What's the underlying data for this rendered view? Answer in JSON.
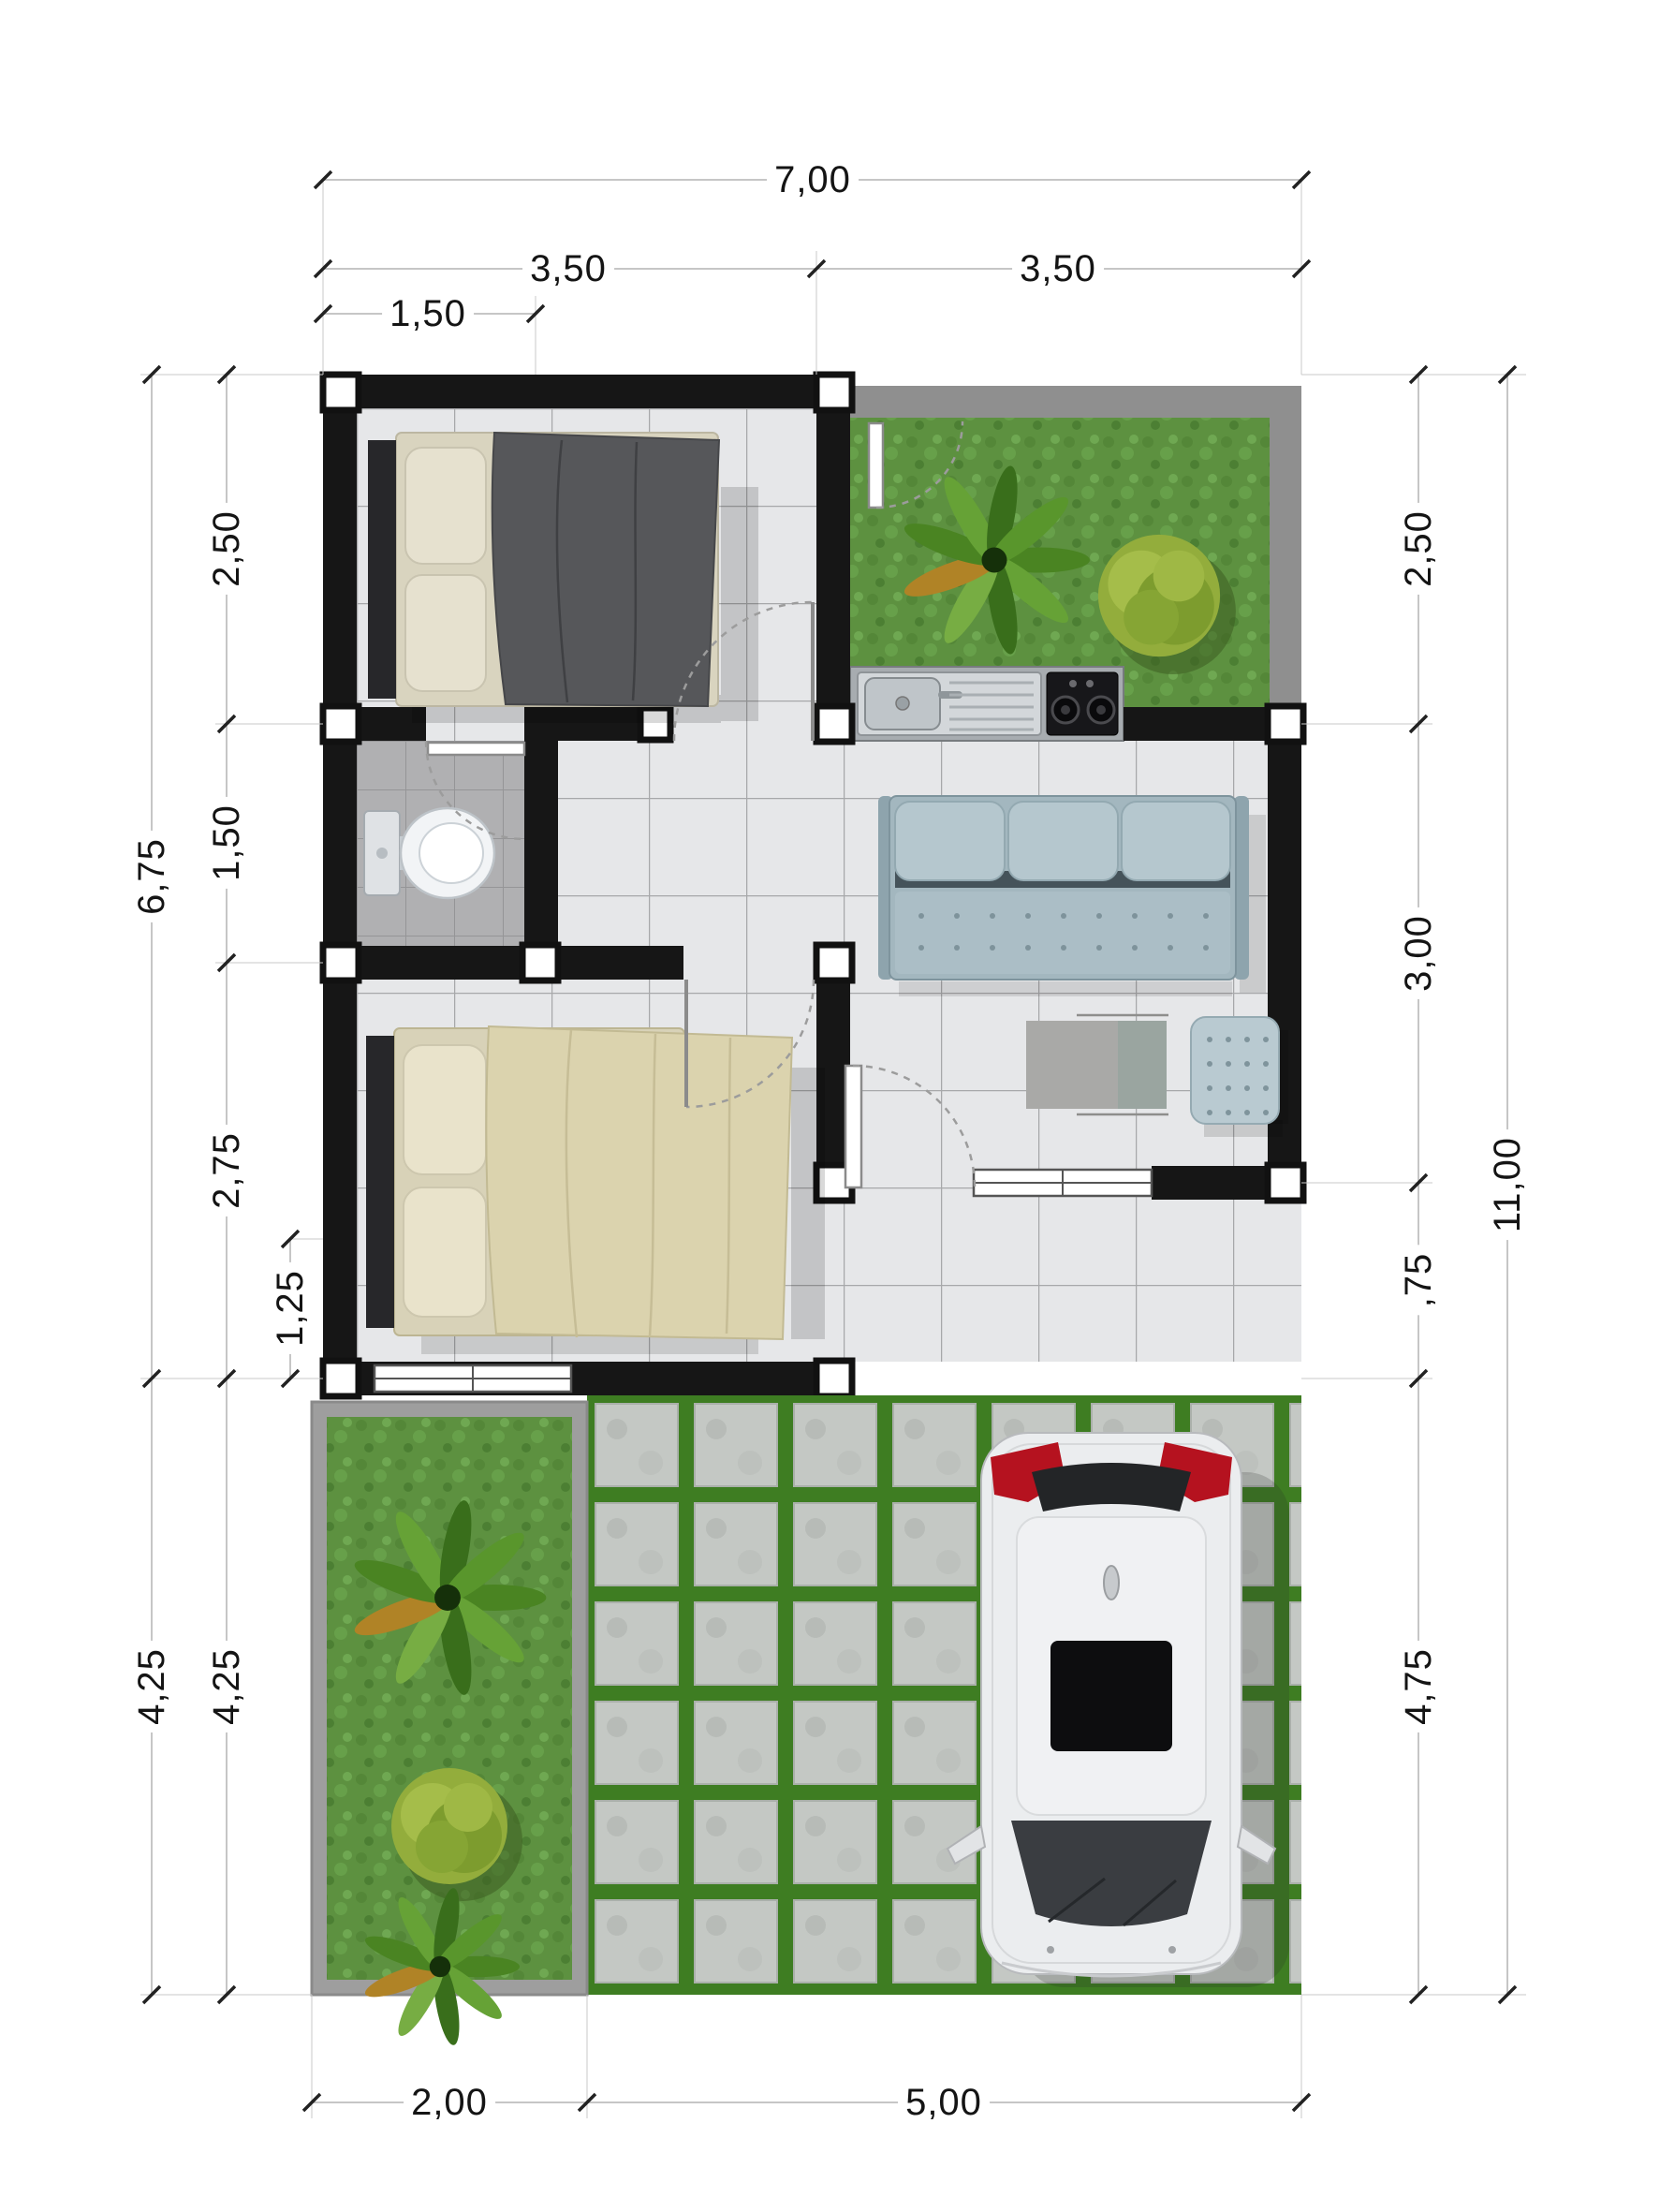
{
  "drawing": {
    "type": "house-floor-plan",
    "units": "meters-with-comma-decimal",
    "scale_note": "top-down architectural plan with photoreal furniture"
  },
  "dimensions": {
    "top": [
      {
        "label": "7,00"
      },
      {
        "label": "3,50"
      },
      {
        "label": "3,50"
      },
      {
        "label": "1,50"
      }
    ],
    "left": [
      {
        "label": "6,75"
      },
      {
        "label": "2,50"
      },
      {
        "label": "1,50"
      },
      {
        "label": "2,75"
      },
      {
        "label": "1,25"
      },
      {
        "label": "4,25"
      },
      {
        "label": "4,25"
      }
    ],
    "right": [
      {
        "label": "2,50"
      },
      {
        "label": "3,00"
      },
      {
        "label": ",75"
      },
      {
        "label": "11,00"
      },
      {
        "label": "4,75"
      }
    ],
    "bottom": [
      {
        "label": "2,00"
      },
      {
        "label": "5,00"
      }
    ]
  },
  "rooms": [
    {
      "name": "bedroom-1",
      "furniture": [
        "double-bed-dark-blanket"
      ]
    },
    {
      "name": "bathroom",
      "furniture": [
        "toilet"
      ]
    },
    {
      "name": "bedroom-2",
      "furniture": [
        "double-bed-beige-duvet"
      ]
    },
    {
      "name": "living-room",
      "furniture": [
        "three-seat-sofa",
        "coffee-table",
        "ottoman"
      ]
    },
    {
      "name": "kitchen-courtyard",
      "furniture": [
        "sink-counter",
        "gas-stove",
        "palm-tree",
        "round-bush"
      ]
    },
    {
      "name": "porch",
      "furniture": []
    },
    {
      "name": "front-garden-strip",
      "furniture": [
        "palm-tree",
        "round-bush",
        "palm-tree"
      ]
    },
    {
      "name": "carport",
      "furniture": [
        "white-car-top-view",
        "grass-block-paving"
      ]
    }
  ],
  "colors": {
    "wall": "#161616",
    "column_marker": "#ffffff",
    "tile_floor": "#e6e7e9",
    "tile_line": "#a7a8aa",
    "bath_tile": "#b3b3b5",
    "grass": "#5d9140",
    "paving_joint": "#3e7d22",
    "paver_block": "#c4c8c4",
    "fence_gray": "#8f8f8f",
    "sofa": "#b5c7ce",
    "bed1_blanket": "#56575a",
    "bed2_duvet": "#dbd3ae",
    "taillight_red": "#b5121f",
    "dimension_text": "#141414",
    "dimension_line": "#b3b3b3"
  }
}
